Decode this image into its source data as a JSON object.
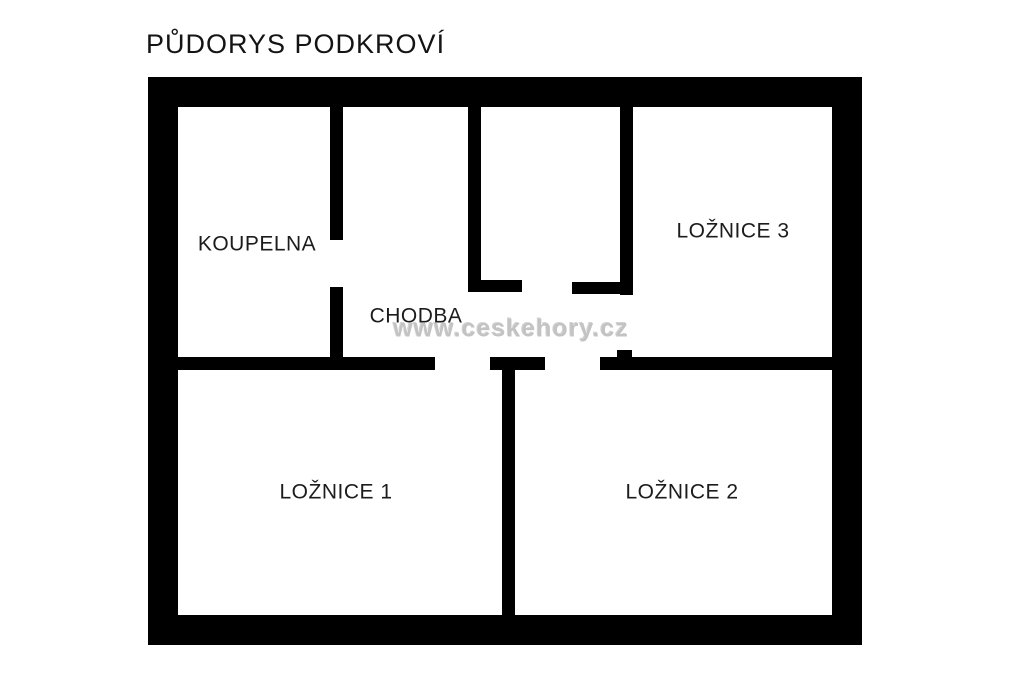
{
  "title": "PŮDORYS PODKROVÍ",
  "watermark": {
    "text": "www.ceskehory.cz",
    "cx": 511,
    "cy": 329
  },
  "colors": {
    "wall": "#000000",
    "background": "#ffffff",
    "label_text": "#1c1c1c",
    "watermark_text": "#c3c3c3"
  },
  "rooms": [
    {
      "id": "koupelna",
      "label": "KOUPELNA",
      "cx": 257,
      "cy": 244
    },
    {
      "id": "chodba",
      "label": "CHODBA",
      "cx": 416,
      "cy": 316
    },
    {
      "id": "loznice-3",
      "label": "LOŽNICE 3",
      "cx": 733,
      "cy": 231
    },
    {
      "id": "loznice-1",
      "label": "LOŽNICE 1",
      "cx": 336,
      "cy": 492
    },
    {
      "id": "loznice-2",
      "label": "LOŽNICE 2",
      "cx": 682,
      "cy": 492
    }
  ],
  "walls": [
    {
      "name": "outer-top",
      "x": 148,
      "y": 77,
      "w": 714,
      "h": 30
    },
    {
      "name": "outer-bottom",
      "x": 148,
      "y": 615,
      "w": 714,
      "h": 30
    },
    {
      "name": "outer-left",
      "x": 148,
      "y": 77,
      "w": 30,
      "h": 568
    },
    {
      "name": "outer-right",
      "x": 832,
      "y": 77,
      "w": 30,
      "h": 568
    },
    {
      "name": "bathroom-wall-upper",
      "x": 330,
      "y": 107,
      "w": 13,
      "h": 133
    },
    {
      "name": "bathroom-wall-lower",
      "x": 330,
      "y": 287,
      "w": 13,
      "h": 83
    },
    {
      "name": "closet-left-wall",
      "x": 468,
      "y": 107,
      "w": 13,
      "h": 185
    },
    {
      "name": "closet-left-foot",
      "x": 468,
      "y": 280,
      "w": 54,
      "h": 12
    },
    {
      "name": "closet-right-foot",
      "x": 572,
      "y": 282,
      "w": 48,
      "h": 12
    },
    {
      "name": "closet-right-wall",
      "x": 620,
      "y": 107,
      "w": 13,
      "h": 188
    },
    {
      "name": "bedroom3-door-stub",
      "x": 617,
      "y": 350,
      "w": 15,
      "h": 8
    },
    {
      "name": "hall-south-wall-left",
      "x": 148,
      "y": 357,
      "w": 287,
      "h": 13
    },
    {
      "name": "bedroom-divider-head",
      "x": 490,
      "y": 357,
      "w": 55,
      "h": 13
    },
    {
      "name": "hall-south-wall-right",
      "x": 600,
      "y": 357,
      "w": 232,
      "h": 13
    },
    {
      "name": "bedroom-divider",
      "x": 502,
      "y": 370,
      "w": 13,
      "h": 245
    }
  ]
}
